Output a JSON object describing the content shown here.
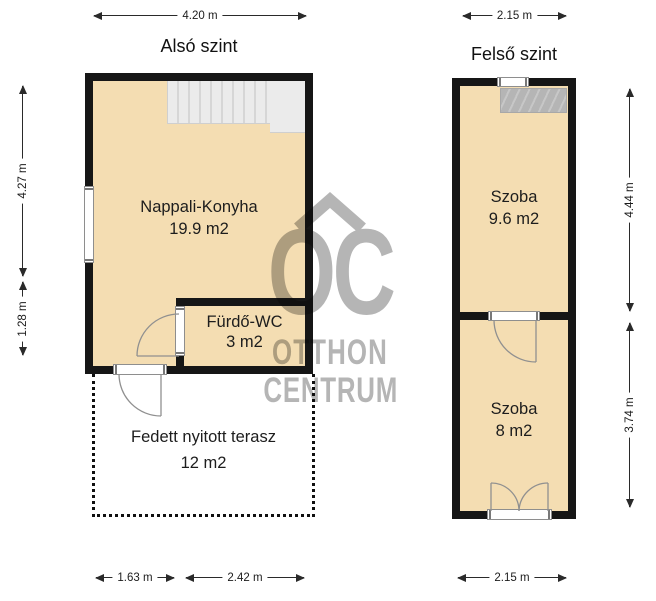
{
  "colors": {
    "room_fill": "#f4ddb2",
    "wall": "#161616",
    "watermark": "#b5b5b5"
  },
  "watermark": {
    "logo": "OC",
    "line1": "OTTHON",
    "line2": "CENTRUM"
  },
  "lower_floor": {
    "title": "Alsó szint",
    "dim_top": "4.20 m",
    "dim_left_upper": "4.27 m",
    "dim_left_lower": "1.28 m",
    "dim_bottom_left": "1.63 m",
    "dim_bottom_right": "2.42 m",
    "rooms": [
      {
        "name": "Nappali-Konyha",
        "area": "19.9 m2"
      },
      {
        "name": "Fürdő-WC",
        "area": "3 m2"
      },
      {
        "name": "Fedett nyitott terasz",
        "area": "12 m2"
      }
    ]
  },
  "upper_floor": {
    "title": "Felső szint",
    "dim_top": "2.15 m",
    "dim_right_upper": "4.44 m",
    "dim_right_lower": "3.74 m",
    "dim_bottom": "2.15 m",
    "rooms": [
      {
        "name": "Szoba",
        "area": "9.6 m2"
      },
      {
        "name": "Szoba",
        "area": "8 m2"
      }
    ]
  }
}
